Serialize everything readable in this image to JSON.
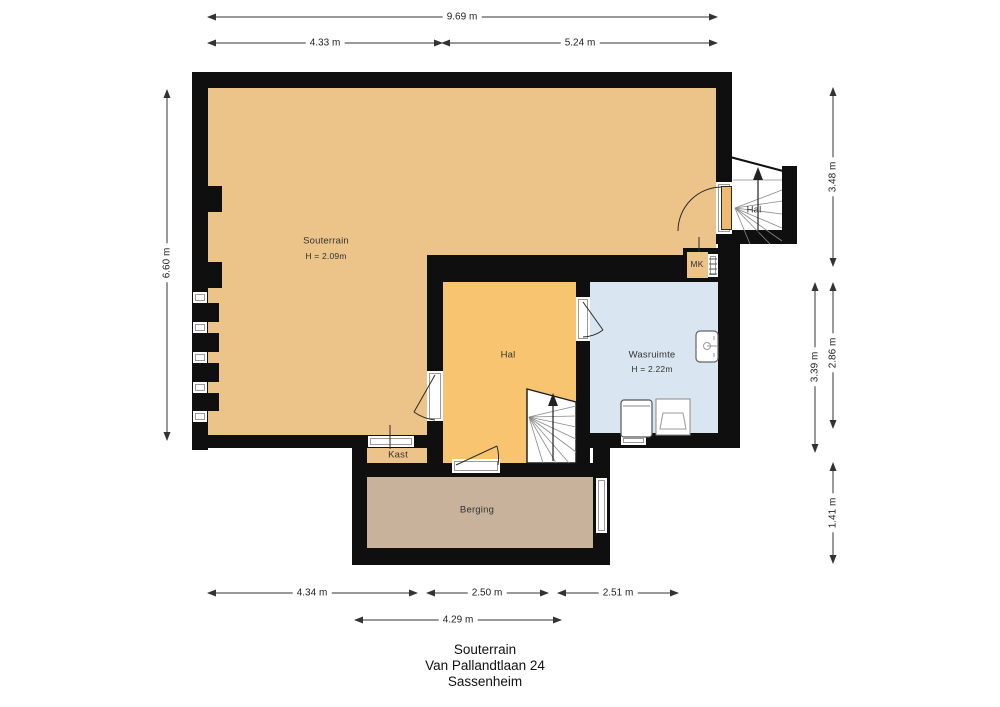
{
  "title_block": {
    "line1": "Souterrain",
    "line2": "Van Pallandtlaan 24",
    "line3": "Sassenheim"
  },
  "rooms": {
    "souterrain": {
      "name": "Souterrain",
      "height": "H = 2.09m"
    },
    "hal_mid": {
      "name": "Hal"
    },
    "hal_top": {
      "name": "Hal"
    },
    "wasruimte": {
      "name": "Wasruimte",
      "height": "H = 2.22m"
    },
    "mk": {
      "name": "MK"
    },
    "kast": {
      "name": "Kast"
    },
    "berging": {
      "name": "Berging"
    }
  },
  "dimensions": {
    "top_total": "9.69 m",
    "top_left": "4.33 m",
    "top_right": "5.24 m",
    "left_height": "6.60 m",
    "right_top": "3.48 m",
    "right_mid_outer": "3.39 m",
    "right_mid_inner": "2.86 m",
    "right_bottom": "1.41 m",
    "bottom_left": "4.34 m",
    "bottom_mid": "2.50 m",
    "bottom_right": "2.51 m",
    "bottom_inner": "4.29 m"
  },
  "icons": {
    "stairs_up_arrow": "stairs-up-arrow-icon",
    "door_swing": "door-swing-arc",
    "window": "window-icon",
    "sink": "sink-icon",
    "washing_machine": "washing-machine-icon",
    "laundry_basket": "laundry-basket-icon",
    "meter_cabinet": "meter-cabinet-icon"
  },
  "colors": {
    "wall": "#0f0f0f",
    "souterrain": "#ecc389",
    "hal": "#f8c470",
    "wasruimte": "#d9e5f1",
    "berging": "#c8b29b",
    "line": "#444444"
  }
}
